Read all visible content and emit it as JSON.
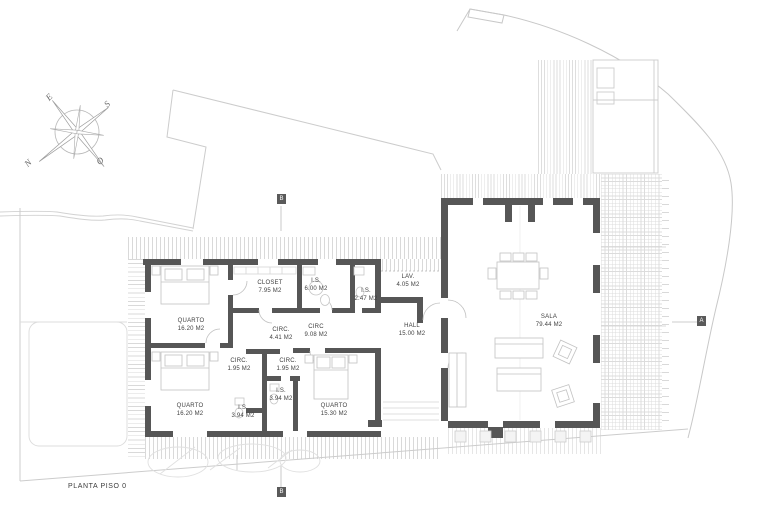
{
  "plan_title": "PLANTA PISO 0",
  "compass": {
    "north": "N",
    "south": "S",
    "east": "E",
    "west": "O"
  },
  "markers": {
    "section_b": "B",
    "section_a": "A"
  },
  "rooms": {
    "quarto1": {
      "name": "QUARTO",
      "area": "16.20 M2"
    },
    "closet": {
      "name": "CLOSET",
      "area": "7.95 M2"
    },
    "is6": {
      "name": "I.S.",
      "area": "6.00 M2"
    },
    "is247": {
      "name": "I.S.",
      "area": "2.47 M2"
    },
    "circ441": {
      "name": "CIRC.",
      "area": "4.41 M2"
    },
    "circ908": {
      "name": "CIRC",
      "area": "9.08 M2"
    },
    "circ195a": {
      "name": "CIRC.",
      "area": "1.95 M2"
    },
    "circ195b": {
      "name": "CIRC.",
      "area": "1.95 M2"
    },
    "is394a": {
      "name": "I.S.",
      "area": "3.94 M2"
    },
    "is394b": {
      "name": "I.S.",
      "area": "3.94 M2"
    },
    "quarto2": {
      "name": "QUARTO",
      "area": "16.20 M2"
    },
    "quarto3": {
      "name": "QUARTO",
      "area": "15.30 M2"
    },
    "lav": {
      "name": "LAV.",
      "area": "4.05 M2"
    },
    "hall": {
      "name": "HALL",
      "area": "15.00 M2"
    },
    "sala": {
      "name": "SALA",
      "area": "79.44 M2"
    }
  },
  "colors": {
    "wall": "#565656",
    "site_line": "#c8c8c8",
    "hatch": "#d9d9d9",
    "furniture_line": "#c2c2c2",
    "text": "#3f3f3f",
    "background": "#ffffff"
  }
}
